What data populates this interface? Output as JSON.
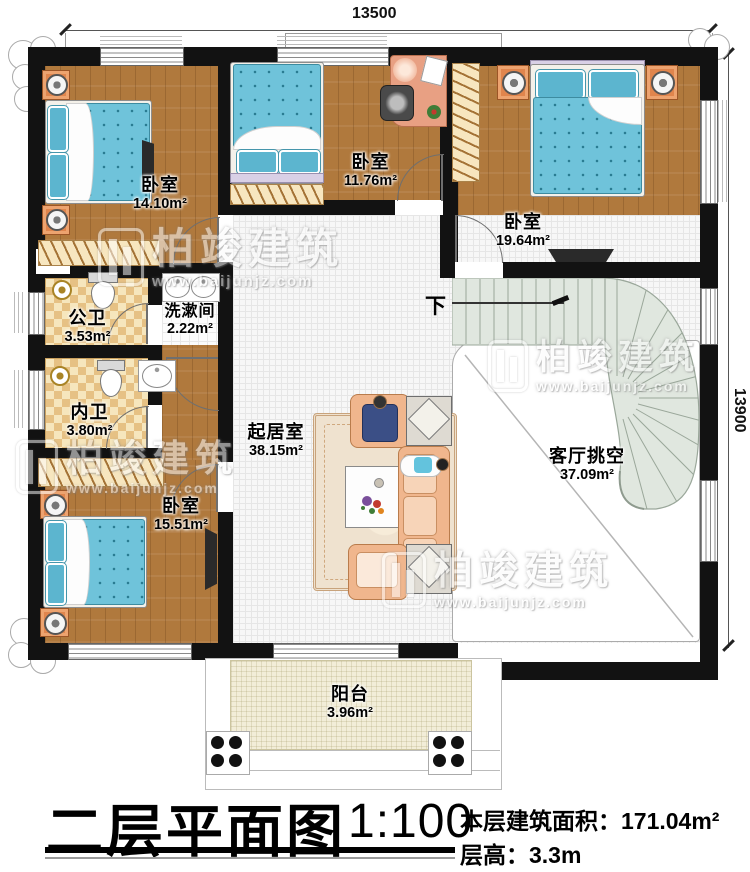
{
  "dimensions": {
    "top": "13500",
    "right": "13900"
  },
  "stairs": {
    "down_label": "下"
  },
  "rooms": [
    {
      "id": "bedroom-top-left",
      "name": "卧室",
      "area": "14.10m²"
    },
    {
      "id": "bedroom-top-mid",
      "name": "卧室",
      "area": "11.76m²"
    },
    {
      "id": "bedroom-top-right",
      "name": "卧室",
      "area": "19.64m²"
    },
    {
      "id": "public-bath",
      "name": "公卫",
      "area": "3.53m²"
    },
    {
      "id": "washroom",
      "name": "洗漱间",
      "area": "2.22m²"
    },
    {
      "id": "ensuite-bath",
      "name": "内卫",
      "area": "3.80m²"
    },
    {
      "id": "bedroom-bottom-left",
      "name": "卧室",
      "area": "15.51m²"
    },
    {
      "id": "living-room",
      "name": "起居室",
      "area": "38.15m²"
    },
    {
      "id": "void-over-parlor",
      "name": "客厅挑空",
      "area": "37.09m²"
    },
    {
      "id": "balcony",
      "name": "阳台",
      "area": "3.96m²"
    }
  ],
  "watermark": {
    "brand": "柏竣建筑",
    "url": "www.baijunjz.com"
  },
  "title_block": {
    "title": "二层平面图",
    "scale": "1:100",
    "area_label": "本层建筑面积：",
    "area_value": "171.04m²",
    "height_label": "层高：",
    "height_value": "3.3m"
  }
}
